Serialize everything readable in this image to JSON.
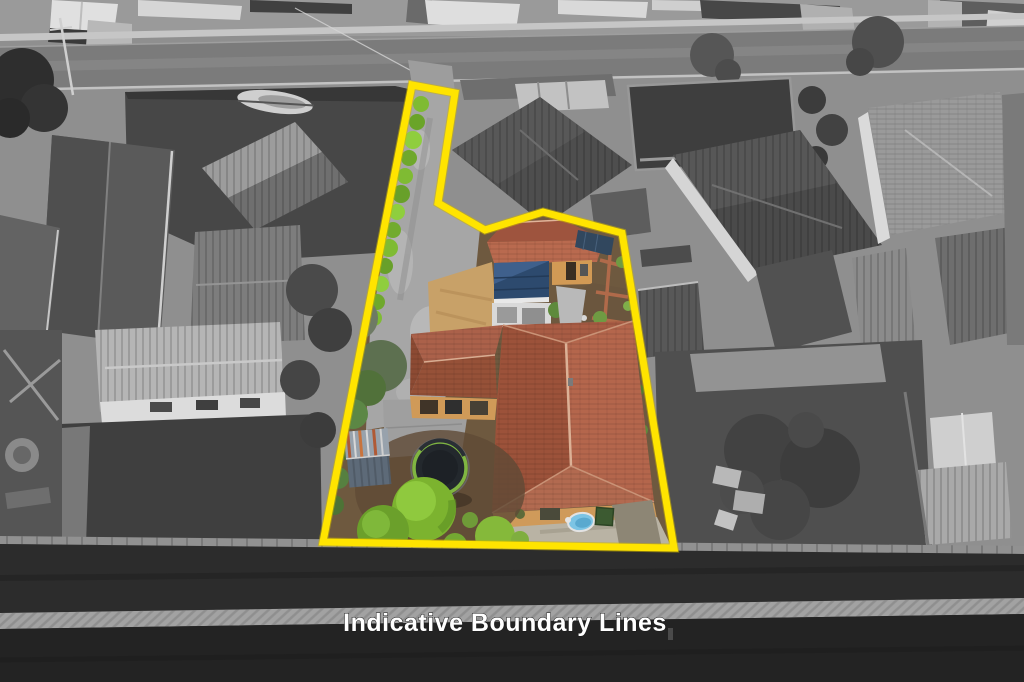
{
  "caption": {
    "text": "Indicative Boundary Lines",
    "color": "#ffffff"
  },
  "boundary": {
    "points": "412,85 455,93 438,203 485,230 543,212 622,233 674,548 323,542",
    "color": "#ffe400",
    "stroke_width": "7",
    "description": "yellow indicative boundary outline around subject parcel"
  },
  "colors": {
    "boundary_yellow": "#ffe400",
    "caption_white": "#ffffff",
    "main_roof_terracotta": "#b4664c",
    "granny_flat_roof": "#b96a4f",
    "awning_blue": "#2d4a6e",
    "shrub_green": "#7cb32f",
    "hedge_green": "#7fbb33",
    "pool_blue": "#7cc4e4",
    "trampoline_rim_green": "#7fb542",
    "shed_rust": "#b05a36",
    "driveway_concrete": "#a6a6a6",
    "road_gray": "#7b7b7b",
    "surroundings_gray": "#8f8f8f",
    "rear_paddock_dark": "#2c2c2c"
  },
  "scene": {
    "type": "aerial-photo",
    "style": "surroundings desaturated to grayscale; subject parcel shown in full colour inside yellow boundary",
    "subject_parcel_features": [
      "long concrete driveway strip with row of green hedge bushes",
      "secondary dwelling with terracotta gable roof, solar panels, blue awning and white deck",
      "main house with large terracotta tiled hip roof",
      "rusty corrugated garden shed",
      "trampoline with safety net",
      "round lime-green garden shrubs",
      "small round blue pool",
      "brick garden paths and mulched beds"
    ],
    "surroundings_features": [
      "street with footpath and grass verge at top",
      "neighbouring houses with grey tiled roofs",
      "boat on trailer in fenced yard",
      "fenced pool enclosure",
      "backyard sheds and outdoor furniture",
      "rear fence lines and dark paddock at bottom"
    ]
  }
}
